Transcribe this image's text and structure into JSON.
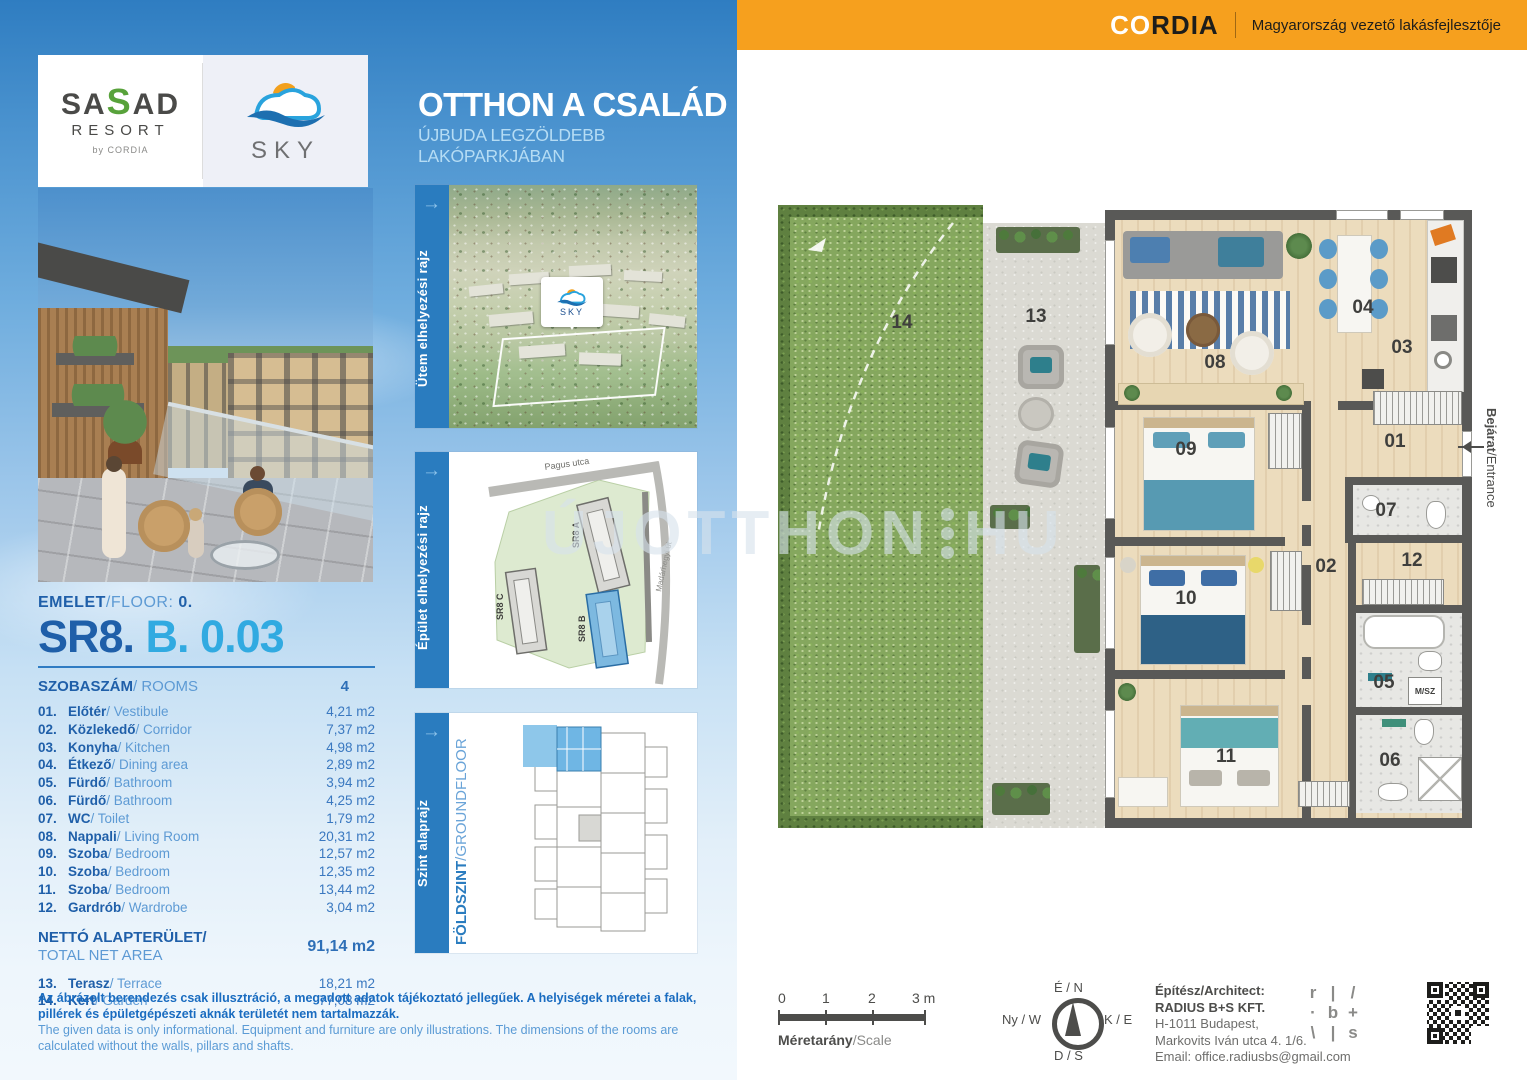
{
  "header": {
    "sasad": {
      "word_pre": "SA",
      "word_green": "S",
      "word_post": "AD",
      "resort": "RESORT",
      "byline": "by CORDIA"
    },
    "sky_label": "SKY",
    "title": "OTTHON A CSALÁD",
    "subtitle": "ÚJBUDA LEGZÖLDEBB LAKÓPARKJÁBAN",
    "cordia_co": "CO",
    "cordia_rdia": "RDIA",
    "cordia_tagline": "Magyarország vezető lakásfejlesztője"
  },
  "unit": {
    "floor_label": "EMELET",
    "floor_label_en": "/FLOOR: ",
    "floor_value": "0.",
    "code_main": "SR8. ",
    "code_sub": "B. 0.03",
    "rooms_label": "SZOBASZÁM",
    "rooms_label_en": "/ ROOMS",
    "rooms_value": "4"
  },
  "rooms": [
    {
      "num": "01.",
      "n": "01",
      "hu": "Előtér",
      "en": "/ Vestibule",
      "area": "4,21 m2"
    },
    {
      "num": "02.",
      "n": "02",
      "hu": "Közlekedő",
      "en": "/ Corridor",
      "area": "7,37 m2"
    },
    {
      "num": "03.",
      "n": "03",
      "hu": "Konyha",
      "en": "/ Kitchen",
      "area": "4,98 m2"
    },
    {
      "num": "04.",
      "n": "04",
      "hu": "Étkező",
      "en": "/ Dining area",
      "area": "2,89 m2"
    },
    {
      "num": "05.",
      "n": "05",
      "hu": "Fürdő",
      "en": "/ Bathroom",
      "area": "3,94 m2"
    },
    {
      "num": "06.",
      "n": "06",
      "hu": "Fürdő",
      "en": "/ Bathroom",
      "area": "4,25 m2"
    },
    {
      "num": "07.",
      "n": "07",
      "hu": "WC",
      "en": "/ Toilet",
      "area": "1,79 m2"
    },
    {
      "num": "08.",
      "n": "08",
      "hu": "Nappali",
      "en": "/ Living Room",
      "area": "20,31 m2"
    },
    {
      "num": "09.",
      "n": "09",
      "hu": "Szoba",
      "en": "/ Bedroom",
      "area": "12,57 m2"
    },
    {
      "num": "10.",
      "n": "10",
      "hu": "Szoba",
      "en": "/ Bedroom",
      "area": "12,35 m2"
    },
    {
      "num": "11.",
      "n": "11",
      "hu": "Szoba",
      "en": "/ Bedroom",
      "area": "13,44 m2"
    },
    {
      "num": "12.",
      "n": "12",
      "hu": "Gardrób",
      "en": "/ Wardrobe",
      "area": "3,04 m2"
    }
  ],
  "net": {
    "label_hu": "NETTÓ ALAPTERÜLET/",
    "label_en": "TOTAL NET AREA",
    "value": "91,14 m2"
  },
  "outdoor": [
    {
      "num": "13.",
      "n": "13",
      "hu": "Terasz",
      "en": "/ Terrace",
      "area": "18,21 m2"
    },
    {
      "num": "14.",
      "n": "14",
      "hu": "Kert",
      "en": "/ Garden",
      "area": "77,08 m2"
    }
  ],
  "disclaimer": {
    "hu": "Az ábrázolt berendezés csak illusztráció, a megadott adatok tájékoztató jellegűek. A helyiségek méretei a falak, pillérek és épületgépészeti aknák területét nem tartalmazzák.",
    "en": "The given data is only informational. Equipment and furniture are only illustrations. The dimensions of the rooms are calculated without the walls, pillars and shafts."
  },
  "thumbnails": {
    "t1_label": "Ütem elhelyezési rajz",
    "t2_label": "Épület elhelyezési rajz",
    "t3_label": "Szint alaprajz",
    "t3_sub_bold": "FÖLDSZINT",
    "t3_sub_light": "/GROUNDFLOOR",
    "t1_marker": "SKY",
    "t2_street_top": "Pagus utca",
    "t2_street_right": "Madárhegyi út",
    "t2_buildings": [
      "SR8 A",
      "SR8 C",
      "SR8 B"
    ]
  },
  "plan": {
    "entrance_hu": "Bejárat",
    "entrance_en": "/Entrance",
    "msz": "M/SZ",
    "watermark_left": "ÚJOTTHON",
    "watermark_right": "HU"
  },
  "footer": {
    "scale_ticks": [
      "0",
      "1",
      "2",
      "3 m"
    ],
    "scale_label_hu": "Méretarány",
    "scale_label_en": "/Scale",
    "compass": {
      "n": "É / N",
      "s": "D / S",
      "w": "Ny / W",
      "e": "K / E"
    },
    "architect": {
      "label": "Építész/Architect:",
      "name": "RADIUS B+S KFT.",
      "addr1": "H-1011 Budapest,",
      "addr2": "Markovits Iván utca 4. 1/6.",
      "email": "Email: office.radiusbs@gmail.com"
    },
    "rbs_grid": [
      "r",
      "|",
      "/",
      "·",
      "b",
      "+",
      "\\",
      "|",
      "s"
    ]
  },
  "colors": {
    "accent_orange": "#f6a01e",
    "accent_blue": "#2a7cbf",
    "code_blue": "#31aae1",
    "dark_blue": "#1f5fa9"
  }
}
